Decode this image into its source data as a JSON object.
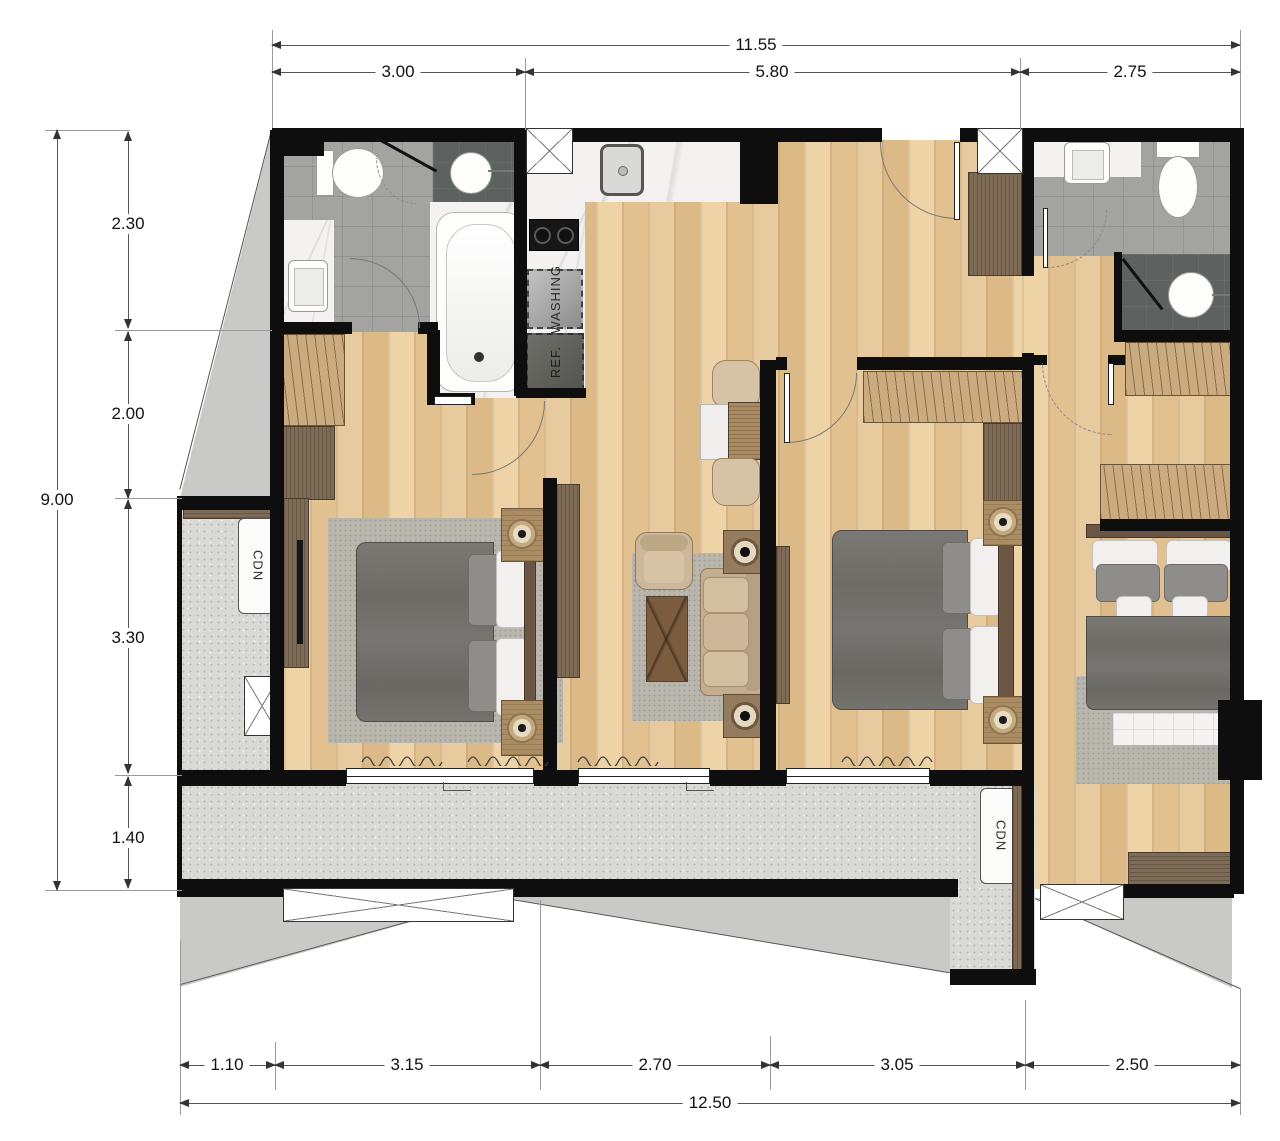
{
  "title": "apartment-floor-plan",
  "dimensions": {
    "top": {
      "overall": "11.55",
      "segments": [
        "3.00",
        "5.80",
        "2.75"
      ]
    },
    "left": {
      "overall": "9.00",
      "segments": [
        "2.30",
        "2.00",
        "3.30",
        "1.40"
      ]
    },
    "bottom": {
      "overall": "12.50",
      "segments": [
        "1.10",
        "3.15",
        "2.70",
        "3.05",
        "2.50"
      ]
    }
  },
  "labels": {
    "washing": "WASHING",
    "refrigerator": "REF.",
    "condenser_left": "CDN",
    "condenser_right": "CDN"
  },
  "colors": {
    "wall": "#0e0e0e",
    "wood_floor": "#e6c79b",
    "balcony_floor": "#d9d9d6",
    "bath_tile": "#a3a3a1",
    "shower_tile": "#5d6160",
    "marble": "#f3f2f0",
    "wardrobe": "#cbab80",
    "dark_wood": "#7e6b56",
    "bedding": "#6e6c67",
    "rug": "#b9b6ae",
    "exterior": "#c9c9c8"
  }
}
